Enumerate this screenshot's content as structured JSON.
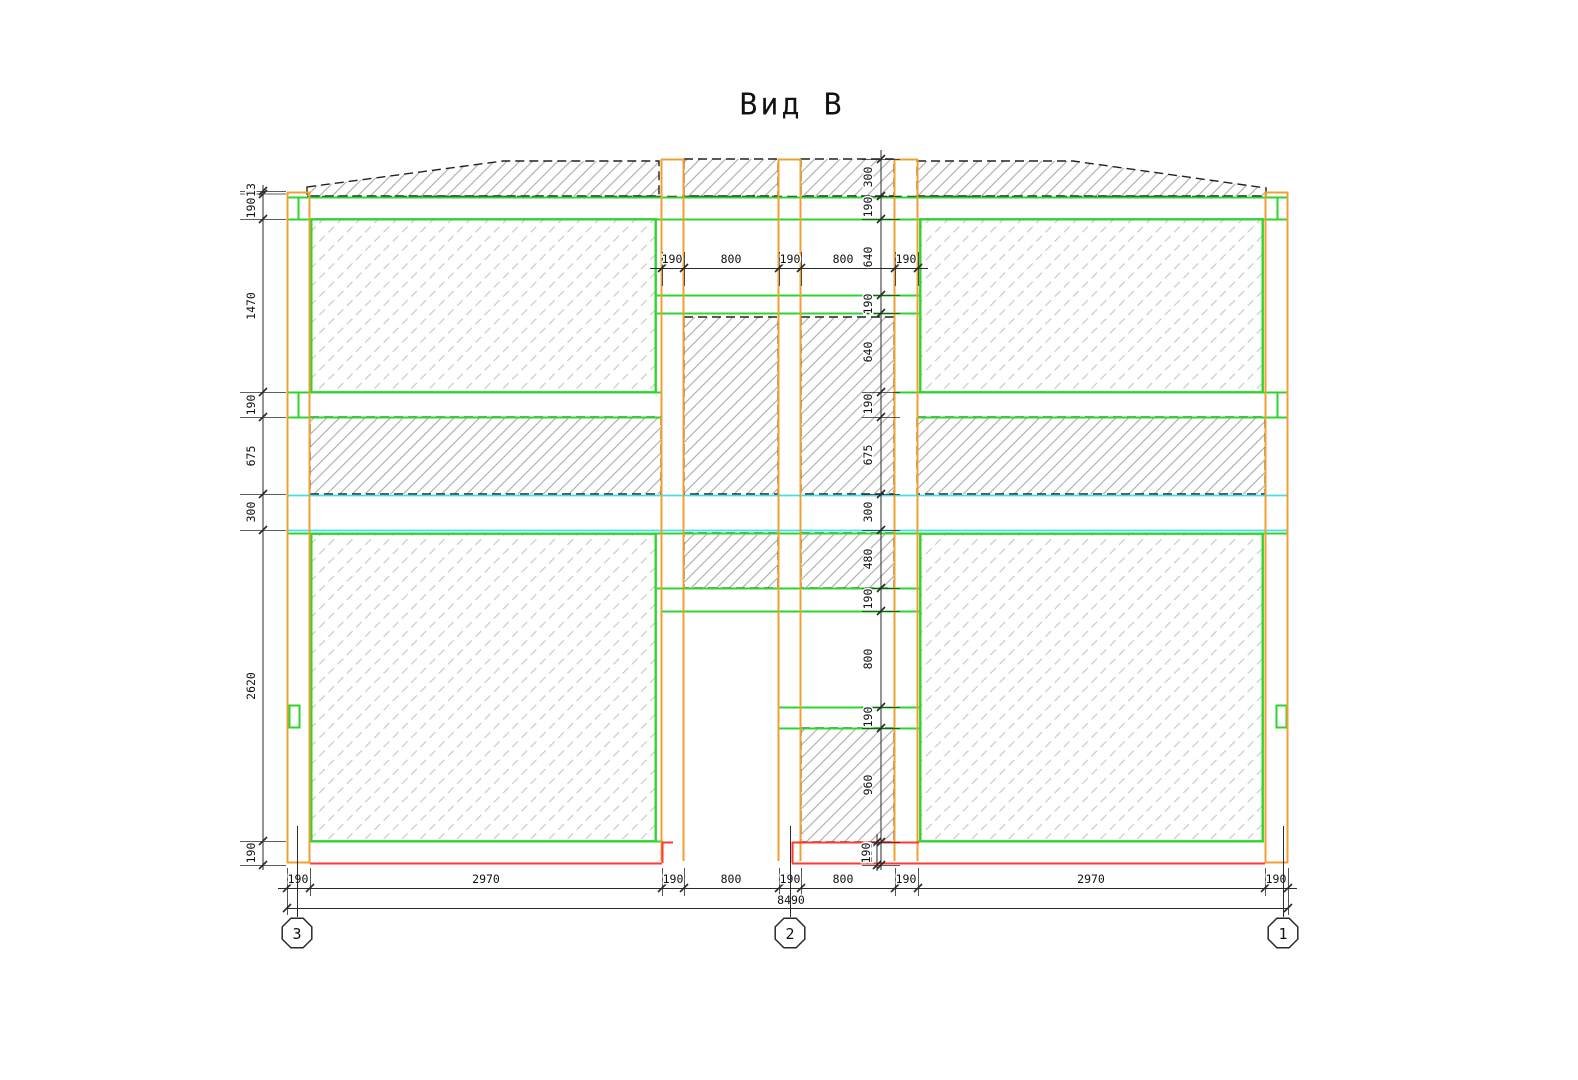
{
  "title": "Вид В",
  "dims": {
    "left": [
      "13",
      "190",
      "1470",
      "190",
      "675",
      "300",
      "2620",
      "190"
    ],
    "center": [
      "300",
      "190",
      "640",
      "190",
      "640",
      "190",
      "675",
      "300",
      "480",
      "190",
      "800",
      "190",
      "960",
      "190"
    ],
    "top": [
      "190",
      "800",
      "190",
      "800",
      "190"
    ],
    "bottom": [
      "190",
      "2970",
      "190",
      "800",
      "190",
      "800",
      "190",
      "2970",
      "190"
    ],
    "total": "8490",
    "base": "190"
  },
  "axes": [
    "3",
    "2",
    "1"
  ],
  "colors": {
    "frame_orange": "#f0a030",
    "panel_green": "#2fd42f",
    "slab_cyan": "#45dde8",
    "base_red": "#ff3a30",
    "dim_line": "#2a2a2a"
  }
}
